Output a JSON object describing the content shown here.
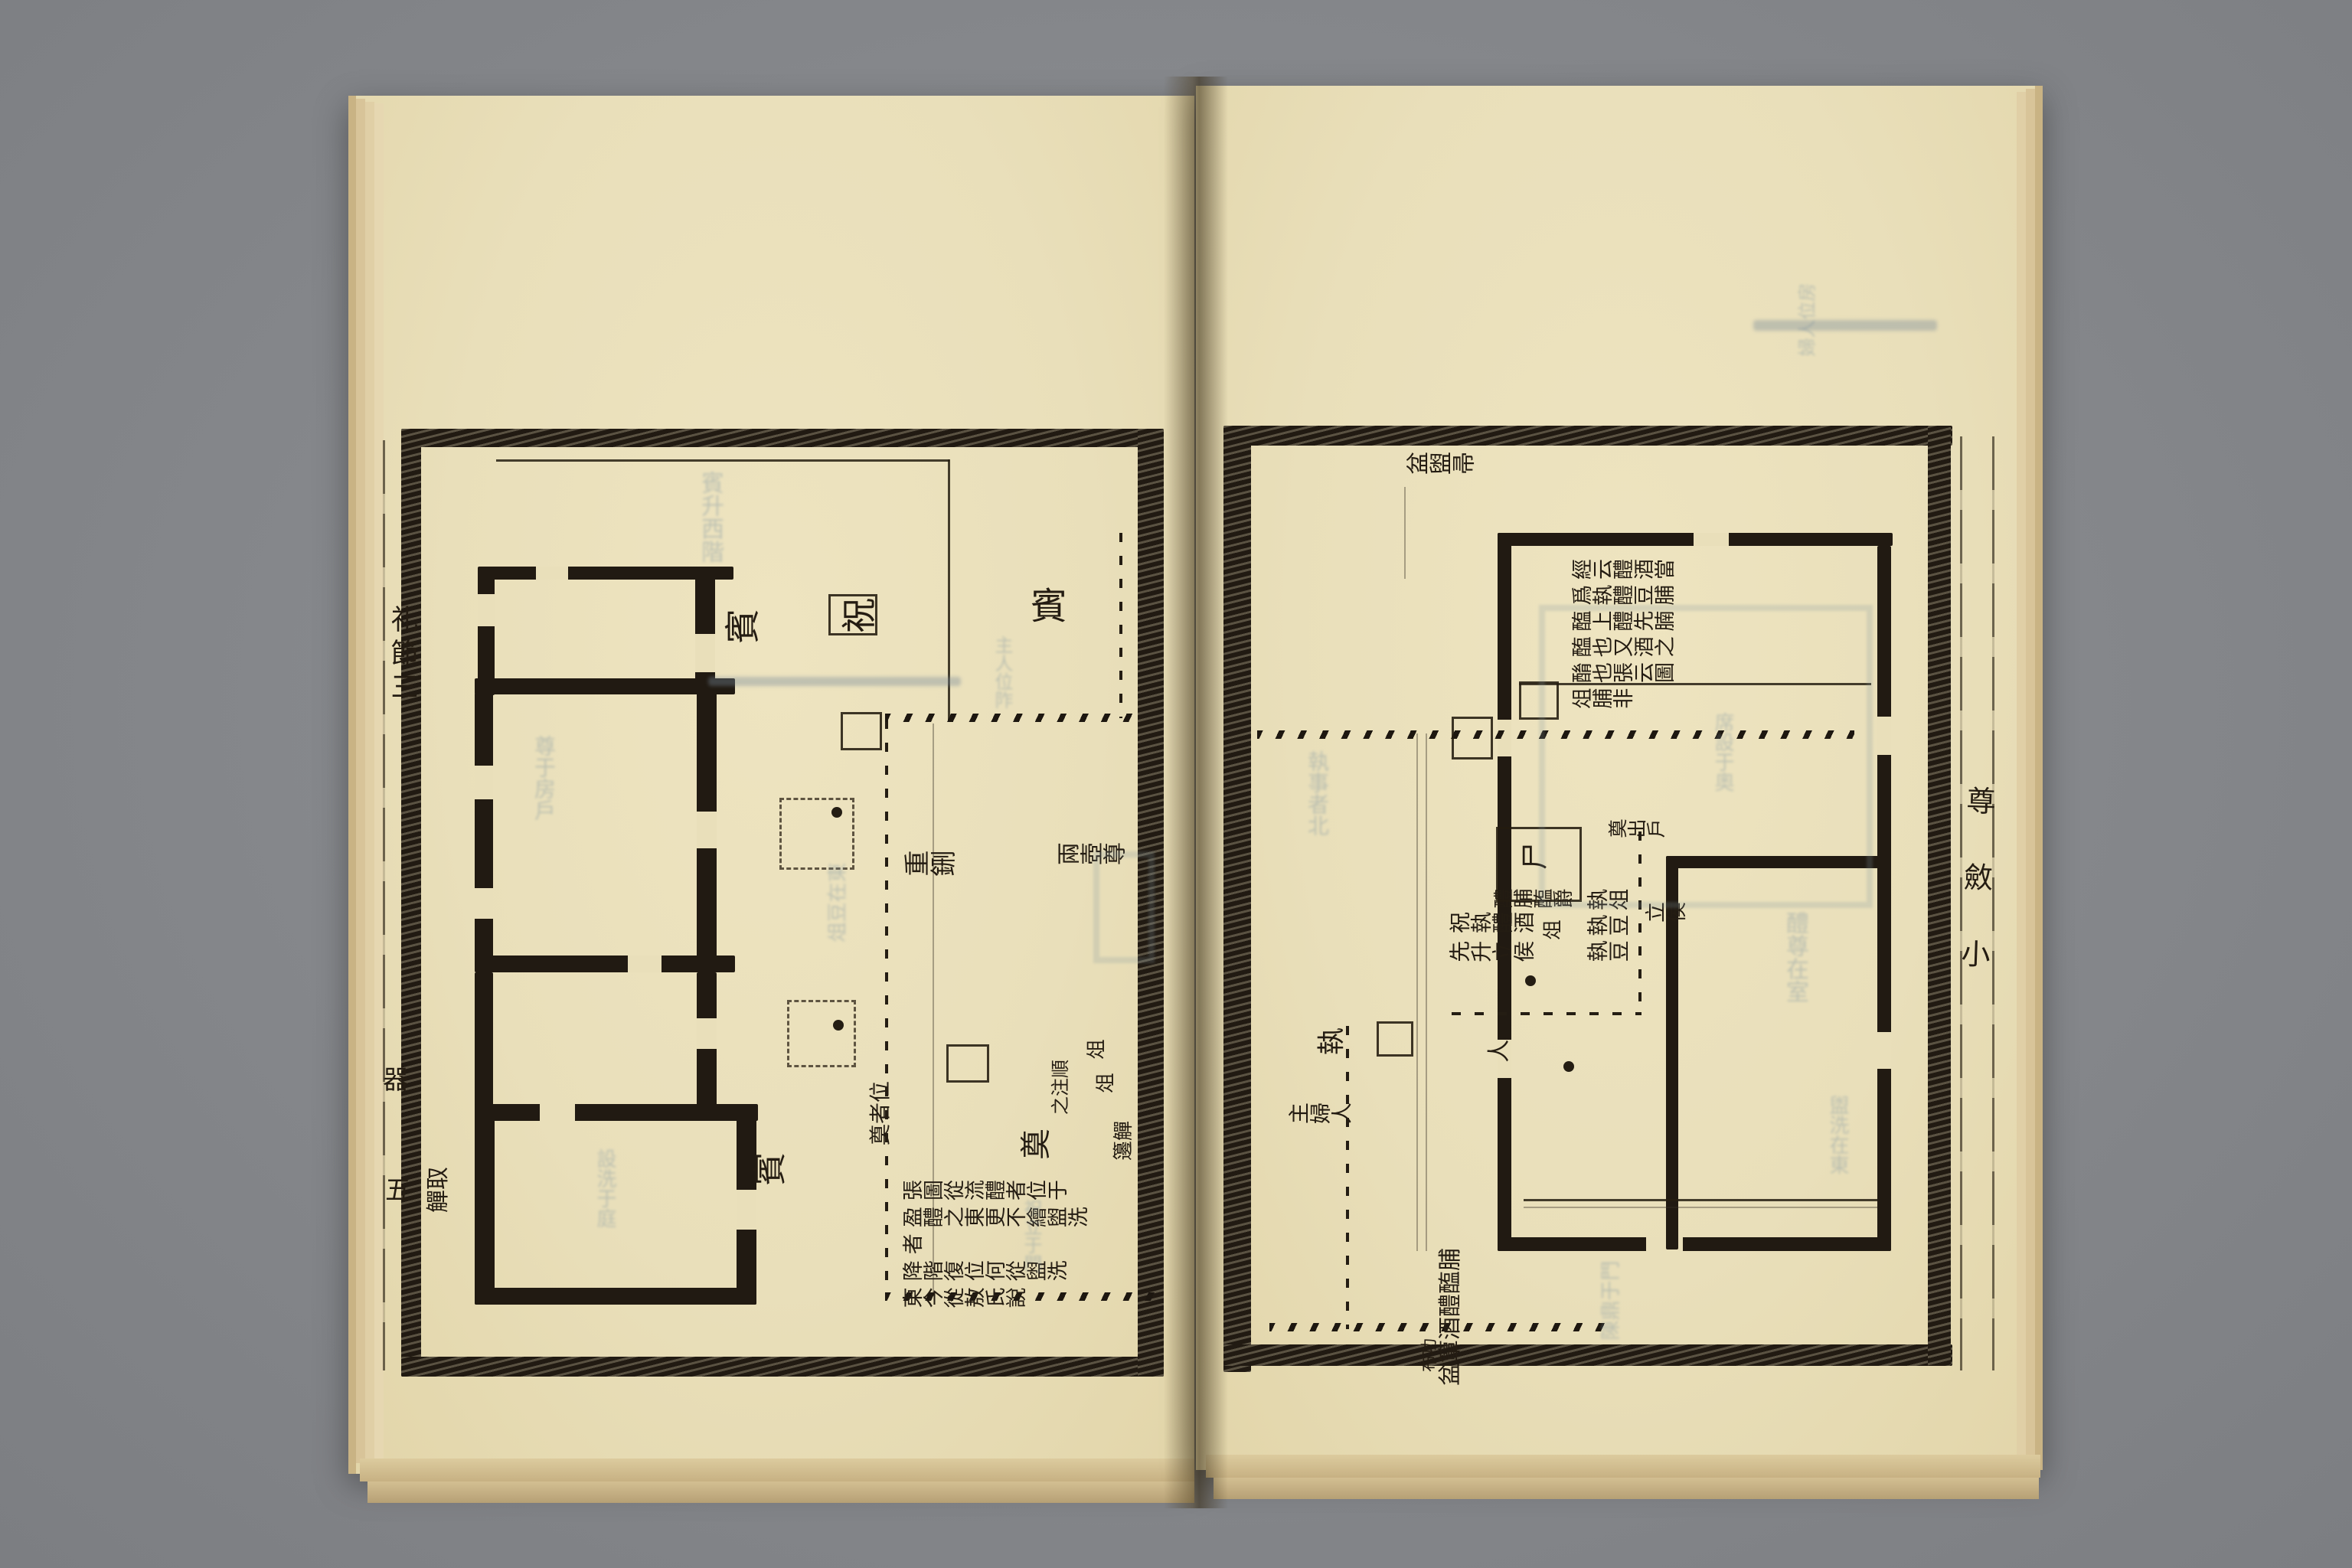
{
  "scene": {
    "desk_color": "#85878b",
    "paper_color": "#e9dfba",
    "ink_color": "#211a12",
    "ghost_color": "#7e95a3"
  },
  "left_page": {
    "margin": {
      "title": "礼節三",
      "char_a": "器",
      "char_b": "五",
      "side_label": "取觶"
    },
    "labels": {
      "guest_nw": "賓",
      "invocator": "祝",
      "guest_ne": "賓",
      "guest_sw": "賓",
      "vessels_center": "重鉶",
      "vessels_east": "兩壺尊",
      "offering": "奠",
      "frag_positions": "位者奠",
      "frag_note": "順注之",
      "frag_stand_a": "俎",
      "frag_stand_b": "俎",
      "frag_cups": "觶籩"
    },
    "note_columns": [
      "張圖從流醴者位于",
      "盈醴之東更不繪盥洗者",
      "降階復位何從盥洗",
      "東今從敖氏說"
    ]
  },
  "right_page": {
    "margin": {
      "chars": "尊斂小"
    },
    "labels": {
      "basin_nw": "盆盥帚",
      "corpse": "尸",
      "offerings_row": "醴脯醢爵",
      "stand": "俎",
      "invocator_group_col1": "祝執醴酒",
      "invocator_group_col2": "先升立侯",
      "bearer_col1": "執俎",
      "bearer_col2": "執豆",
      "bearer_col3": "執豆",
      "stand_wait": "立侯",
      "exit_note": "奠出戶",
      "holder": "執",
      "mistress": "主婦人",
      "person": "人",
      "inventory": "脯醢醴酒簞盆",
      "inventory2": "功布"
    },
    "note_columns": [
      "經云醴酒當",
      "爲執醴豆脯",
      "醢上醴先腩",
      "醢也又酒之",
      "酳也張云圖",
      "俎脯非"
    ]
  },
  "showthrough": [
    "賓升西階",
    "尊于房戶",
    "設洗于庭",
    "俎豆在東",
    "主人位阼",
    "祝立于門",
    "醴尊在室",
    "席設于奧",
    "執事者北",
    "盥洗在東",
    "陳鼎于門",
    "婦人位房"
  ]
}
